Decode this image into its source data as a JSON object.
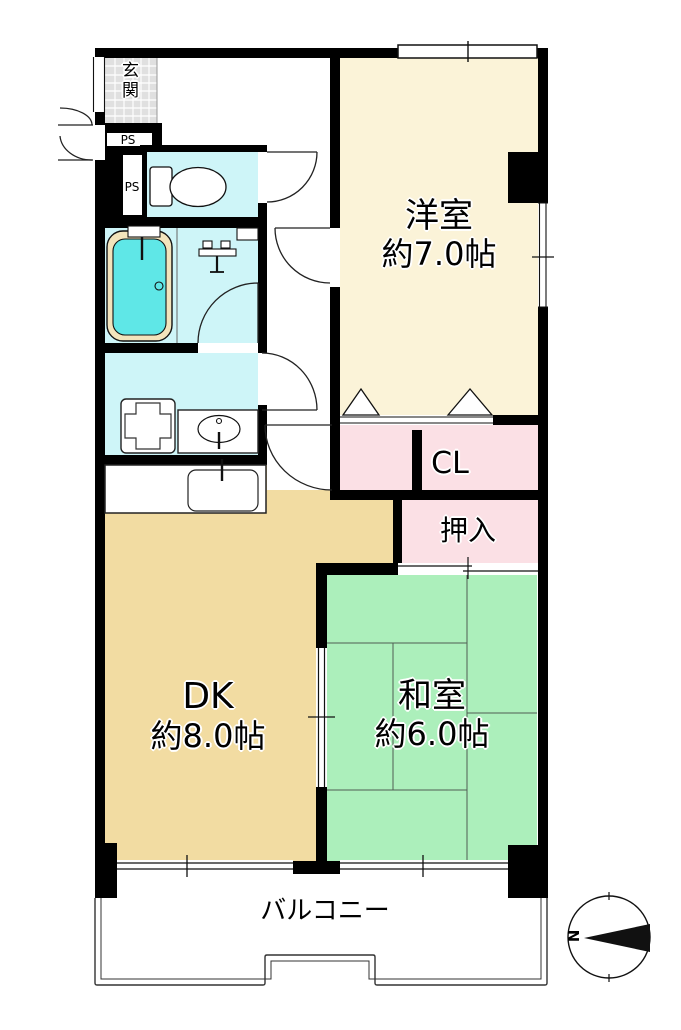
{
  "rooms": {
    "entrance": {
      "label": "玄関"
    },
    "western_room": {
      "name": "洋室",
      "size": "約7.0帖"
    },
    "closet": {
      "label": "CL"
    },
    "oshiire": {
      "label": "押入"
    },
    "dining_kitchen": {
      "name": "DK",
      "size": "約8.0帖"
    },
    "japanese_room": {
      "name": "和室",
      "size": "約6.0帖"
    },
    "balcony": {
      "label": "バルコニー"
    }
  },
  "utilities": {
    "pipe_space_upper": "PS",
    "pipe_space_lower": "PS"
  },
  "compass": {
    "north_label": "N"
  },
  "colors": {
    "wall": "#000000",
    "western_room": "#FBF3D8",
    "japanese_room": "#ACEFBB",
    "dining_kitchen": "#F2DCA2",
    "closet_pink": "#FBE0E5",
    "wet_area": "#CEF5F8",
    "bathtub": "#5FE7E7",
    "bathtub_rim": "#F2E4BC",
    "entrance_tile": "#E0E0E0"
  }
}
